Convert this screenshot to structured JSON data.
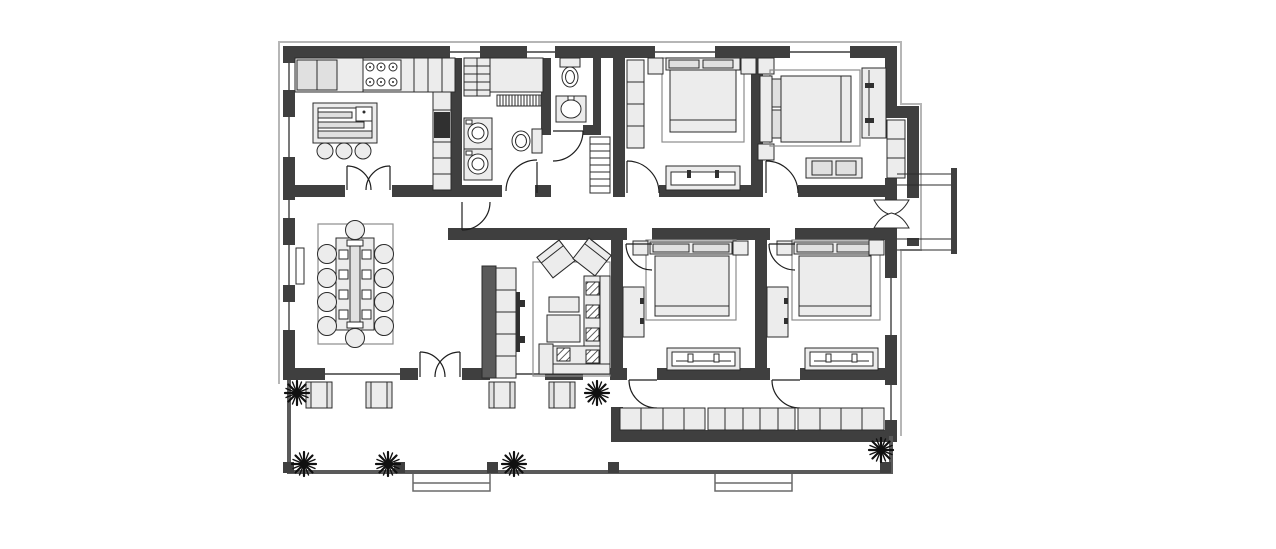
{
  "document": {
    "type": "architectural-floor-plan",
    "style": "black-and-white top-view blueprint",
    "visible_text": "none"
  },
  "palette": {
    "bg": "#ffffff",
    "wall": "#3f3f3f",
    "furn": "#ececec",
    "line": "#2b2b2b",
    "rug": "#8d8d8d",
    "appliance": "#303030",
    "eave": "#b6b6b6",
    "porch": "#5a5a5a"
  },
  "rooms": [
    {
      "id": "kitchen",
      "position": "top-left",
      "features": [
        "wall-counter",
        "refrigerator",
        "cooktop-6-burner",
        "tall-cabinet-column",
        "built-in-oven",
        "island-with-sink",
        "three-stools",
        "double-swing-door-to-dining"
      ]
    },
    {
      "id": "utility-laundry",
      "position": "top-center-left",
      "features": [
        "shelving-unit",
        "counter",
        "radiator",
        "washer",
        "dryer",
        "toilet",
        "swing-door"
      ]
    },
    {
      "id": "wc",
      "position": "top-center",
      "features": [
        "toilet",
        "washbasin",
        "swing-door"
      ]
    },
    {
      "id": "bedroom-1",
      "position": "top-center-right",
      "features": [
        "double-bed",
        "two-nightstands",
        "wardrobe-column",
        "low-dresser",
        "swing-door"
      ]
    },
    {
      "id": "bedroom-2",
      "position": "top-right",
      "features": [
        "double-bed",
        "two-nightstands",
        "desk",
        "bench-with-trays",
        "corner-wardrobe",
        "swing-door"
      ]
    },
    {
      "id": "dining-room",
      "position": "middle-left",
      "features": [
        "rug",
        "long-table",
        "ten-chairs",
        "place-settings"
      ]
    },
    {
      "id": "living-room",
      "position": "middle-center",
      "features": [
        "media-wall-tv",
        "rug",
        "two-armchairs",
        "two-coffee-tables",
        "l-shaped-sofa",
        "cushions"
      ]
    },
    {
      "id": "bedroom-3",
      "position": "bottom-center-left",
      "features": [
        "double-bed",
        "two-nightstands",
        "dresser",
        "bench",
        "two-swing-doors"
      ]
    },
    {
      "id": "bedroom-4",
      "position": "bottom-center-right",
      "features": [
        "double-bed",
        "two-nightstands",
        "dresser",
        "bench",
        "two-swing-doors"
      ]
    },
    {
      "id": "corridor",
      "position": "center",
      "features": [
        "radiator-shoe-cabinet",
        "swing-door-to-dining",
        "double-acting-side-entrance-door"
      ]
    },
    {
      "id": "wardrobe-hallway",
      "position": "bottom-right-inside",
      "features": [
        "built-in-closet-row-13-cells",
        "opening-to-porch"
      ]
    },
    {
      "id": "porch",
      "position": "bottom",
      "features": [
        "four-armchairs",
        "six-plants",
        "double-entrance-door",
        "two-step-flights",
        "corner-posts",
        "side-landing-with-steps"
      ]
    }
  ],
  "counts": {
    "bedrooms": 4,
    "bathrooms": 2,
    "dining_chairs": 10,
    "island_stools": 3,
    "porch_chairs": 4,
    "plants": 6,
    "closet_cells": 13
  },
  "icons": {
    "plant-icon": "eight-point starburst",
    "door-swing-icon": "quarter-circle arc",
    "double-door-icon": "butterfly twin arcs",
    "double-acting-door-icon": "hourglass bowtie"
  }
}
